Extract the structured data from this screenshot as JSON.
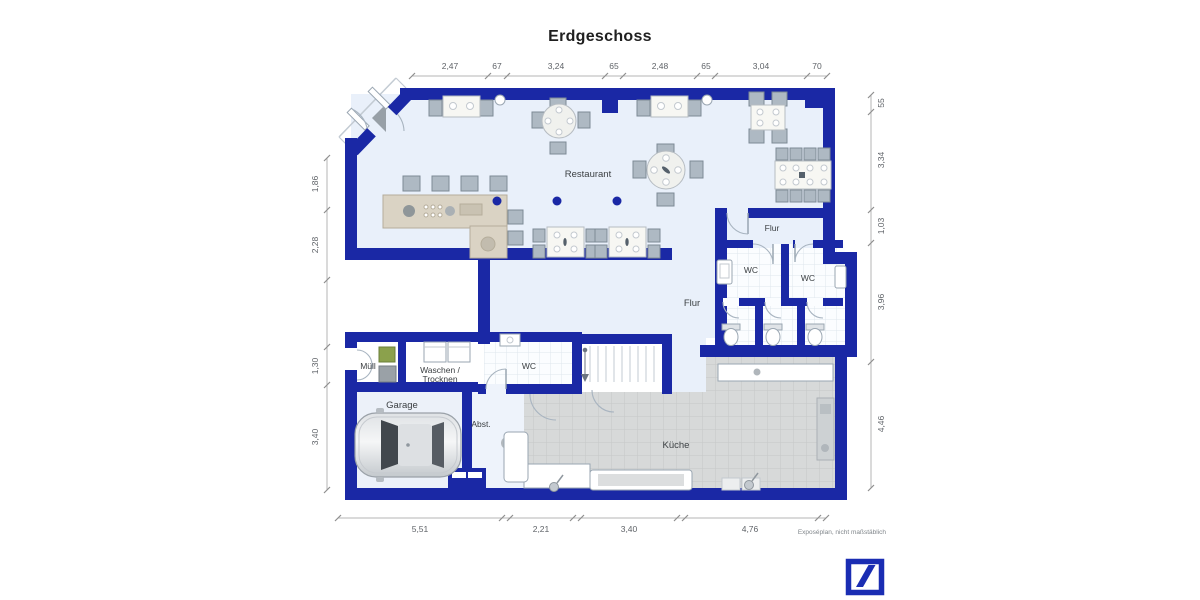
{
  "title": "Erdgeschoss",
  "plan": {
    "rooms": {
      "restaurant": "Restaurant",
      "flur_wc": "Flur",
      "wc_left": "WC",
      "wc_right": "WC",
      "flur_main": "Flur",
      "muell": "Müll",
      "waschen_line1": "Waschen /",
      "waschen_line2": "Trocknen",
      "garage": "Garage",
      "abstellraum": "Abst.",
      "wc_small": "WC",
      "kueche": "Küche"
    },
    "dimensions": {
      "top": [
        "2,47",
        "67",
        "3,24",
        "65",
        "2,48",
        "65",
        "3,04",
        "70"
      ],
      "left": [
        "1,86",
        "2,28",
        "1,30",
        "3,40"
      ],
      "right": [
        "55",
        "3,34",
        "1,03",
        "3,96",
        "4,46"
      ],
      "bottom": [
        "5,51",
        "2,21",
        "3,40",
        "4,76"
      ]
    },
    "footnote": "Exposéplan, nicht maßstäblich"
  },
  "colors": {
    "wall": "#1a28a5",
    "floor": "#e9f0fa",
    "kitchen_floor": "#d7d9d9",
    "bar_counter": "#dad3c4",
    "logo_blue": "#1a2db3"
  },
  "branding": {
    "logo": "deutsche-bank-slash-icon"
  }
}
